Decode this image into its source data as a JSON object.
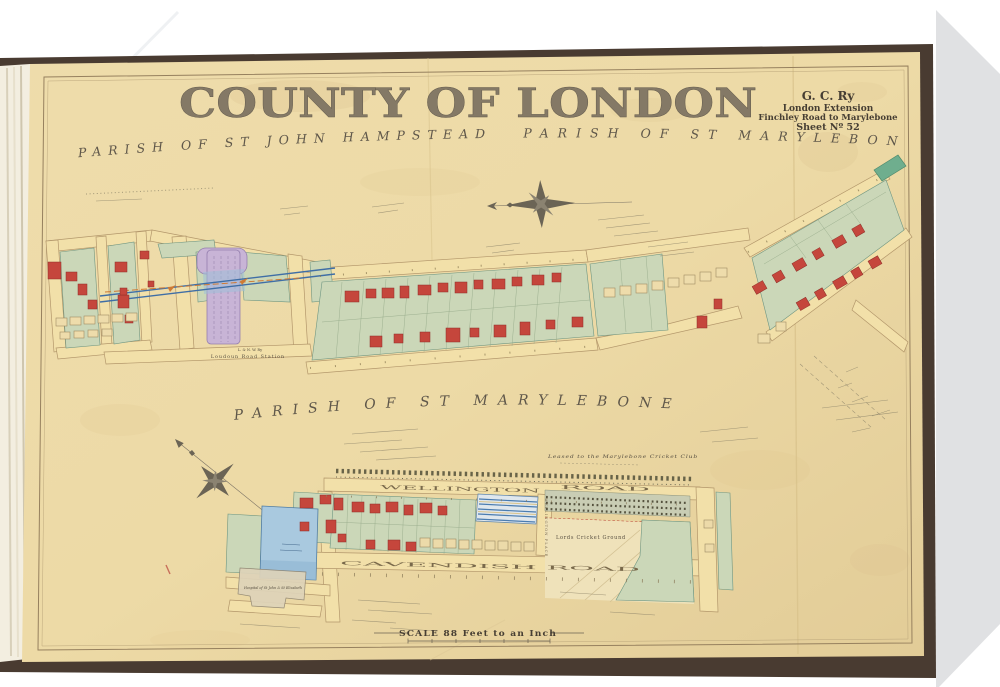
{
  "photo": {
    "background_color": "#ffffff",
    "mat_corner_color": "#e0e1e3",
    "book_cover_color": "#493b31",
    "page_color": "#ecd9a9"
  },
  "page": {
    "title": "COUNTY OF LONDON",
    "cartouche": {
      "railway": "G. C. Ry",
      "line2": "London Extension",
      "line3": "Finchley Road to Marylebone",
      "line4": "Sheet Nº 52"
    },
    "parishes": {
      "top_left": "PARISH OF ST JOHN HAMPSTEAD",
      "top_right": "PARISH OF ST MARYLEBONE",
      "middle": "PARISH OF ST MARYLEBONE"
    },
    "labels": {
      "station_company": "L. & N. W. Ry",
      "station_name": "Loudoun Road Station",
      "lords": "Lords Cricket Ground",
      "lease_note": "Leased to the Marylebone Cricket Club",
      "hospital": "Hospital of St John & St Elizabeth",
      "street_wellington": "WELLINGTON",
      "street_road": "ROAD",
      "street_cavendish": "CAVENDISH ROAD",
      "street_wellington_place": "WELLINGTON PLACE",
      "scale": "SCALE 88 Feet to an Inch"
    },
    "palette": {
      "road": "#f2e0a9",
      "parcel_green": "#cbd7b8",
      "building_red": "#c5463c",
      "railway_blue": "#3f6ea6",
      "station_lilac": "#c8b4d6",
      "water_blue": "#a9c9df",
      "teal_road": "#6fae8e"
    }
  }
}
